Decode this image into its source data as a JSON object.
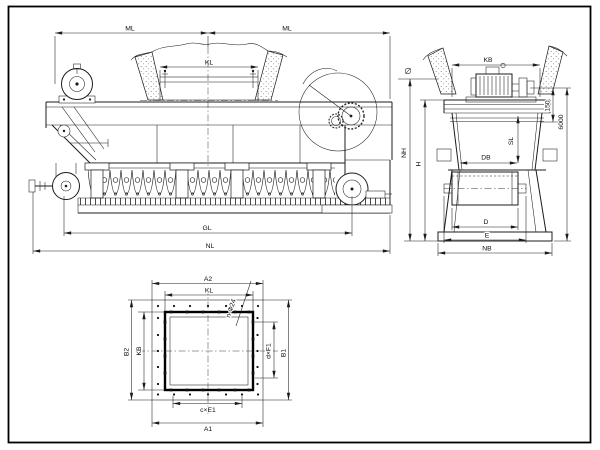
{
  "colors": {
    "background": "#ffffff",
    "line": "#1c1c1c"
  },
  "side_view": {
    "dim_ml_left": "ML",
    "dim_ml_right": "ML",
    "dim_kl": "KL",
    "dim_gl": "GL",
    "dim_nl": "NL"
  },
  "end_view": {
    "dim_kb": "KB",
    "dim_150": "150",
    "dim_6000": "6000",
    "dim_sl": "SL",
    "dim_db": "DB",
    "dim_nh": "NH",
    "dim_h": "H",
    "dim_d": "D",
    "dim_e": "E",
    "dim_nb": "NB"
  },
  "plan_view": {
    "dim_a2": "A2",
    "dim_kl": "KL",
    "dim_b2": "B2",
    "dim_kb": "KB",
    "dim_b1": "B1",
    "dim_d_xf1": "d×F1",
    "dim_c_xe1": "c×E1",
    "dim_a1": "A1",
    "holes_note": "n-Φ24"
  }
}
